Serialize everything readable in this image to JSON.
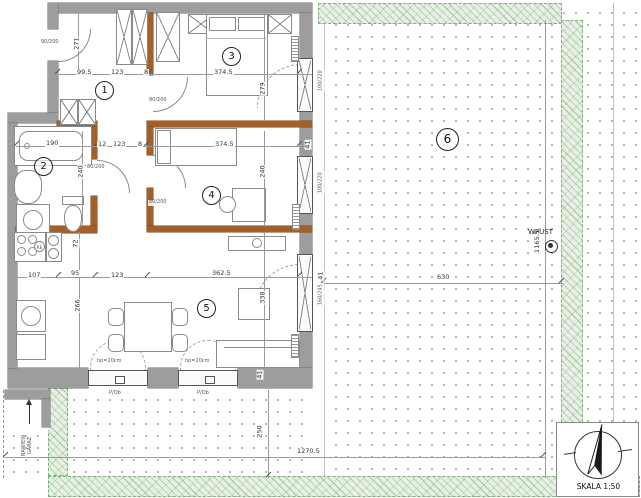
{
  "plan": {
    "rooms": [
      {
        "n": "1"
      },
      {
        "n": "2"
      },
      {
        "n": "3"
      },
      {
        "n": "4"
      },
      {
        "n": "5"
      },
      {
        "n": "6"
      }
    ],
    "dims": {
      "c271": "271",
      "c99_5": "99.5",
      "c123a": "123",
      "c8a": "8",
      "c374_5a": "374.5",
      "c279": "279",
      "c12": "12",
      "c123b": "123",
      "c8b": "8",
      "c374_5b": "374.5",
      "c41a": "41",
      "c190": "190",
      "c240a": "240",
      "c240b": "240",
      "c72": "72",
      "c266": "266",
      "c107": "107",
      "c95": "95",
      "c123c": "123",
      "c362_5": "362.5",
      "c338": "338",
      "c41b": "41",
      "c41c": "41",
      "c250": "250",
      "c1270_5": "1270.5",
      "c630": "630",
      "c1165_5": "1165.5"
    },
    "openings": {
      "entrance": "90/200",
      "win3": "100/220",
      "win4": "100/220",
      "win5": "160/245",
      "door3": "80/200",
      "door4": "80/200",
      "doorBath": "80/200",
      "sill1": "hp=20cm",
      "sill2": "hp=20cm",
      "note1": "P/Ob",
      "note2": "P/Ob",
      "stove_badge": "RE"
    },
    "annotations": {
      "wpust": "WPUST",
      "garage_line1": "NAWIEW",
      "garage_line2": "GARAŻ",
      "scale": "SKALA 1:50"
    }
  }
}
